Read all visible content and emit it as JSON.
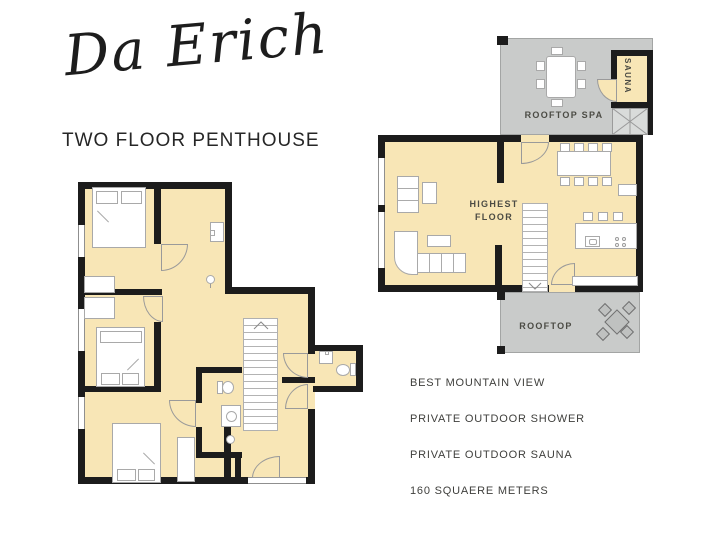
{
  "header": {
    "brand": "Da Erich",
    "subtitle": "TWO FLOOR PENTHOUSE"
  },
  "upper_floor": {
    "rooftop_spa_label": "ROOFTOP SPA",
    "sauna_label": "SAUNA",
    "highest_floor_line1": "HIGHEST",
    "highest_floor_line2": "FLOOR",
    "rooftop_label": "ROOFTOP"
  },
  "features": {
    "items": [
      "BEST MOUNTAIN VIEW",
      "PRIVATE OUTDOOR SHOWER",
      "PRIVATE OUTDOOR SAUNA",
      "160 SQUAERE METERS"
    ]
  },
  "colors": {
    "floor_fill": "#f8e6b6",
    "terrace_fill": "#c9cbca",
    "wall": "#1c1c1c",
    "text": "#3f3f3c"
  }
}
